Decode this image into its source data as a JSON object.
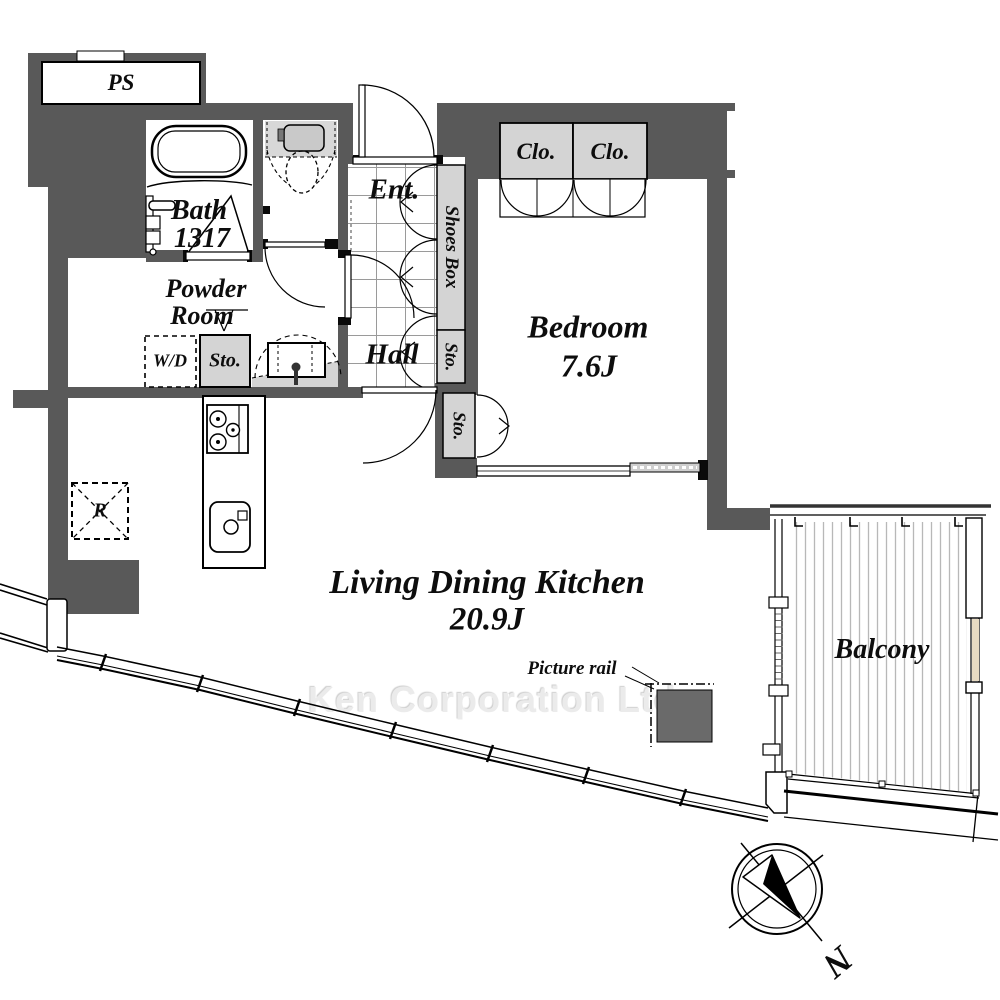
{
  "colors": {
    "wall": "#595959",
    "fixture_gray": "#d4d4d4",
    "tank_gray": "#c9c9c9",
    "pillar": "#6a6a6a",
    "balcony_stripe": "#b8b8b8",
    "watermark_gray": "#ebebeb"
  },
  "rooms": {
    "ps": {
      "label": "PS"
    },
    "bath": {
      "label": "Bath",
      "size": "1317"
    },
    "powder_room": {
      "line1": "Powder",
      "line2": "Room"
    },
    "entrance": {
      "label": "Ent."
    },
    "hall": {
      "label": "Hall"
    },
    "bedroom": {
      "label": "Bedroom",
      "size": "7.6J"
    },
    "ldk": {
      "label": "Living Dining Kitchen",
      "size": "20.9J"
    },
    "balcony": {
      "label": "Balcony"
    }
  },
  "storage": {
    "shoes_box": "Shoes Box",
    "sto_entry": "Sto.",
    "sto_bedroom": "Sto.",
    "sto_powder": "Sto.",
    "closet_left": "Clo.",
    "closet_right": "Clo."
  },
  "appliances": {
    "washer_dryer": "W/D",
    "refrigerator": "R"
  },
  "annotations": {
    "picture_rail": "Picture rail",
    "north": "N",
    "watermark": "Ken Corporation Ltd."
  }
}
